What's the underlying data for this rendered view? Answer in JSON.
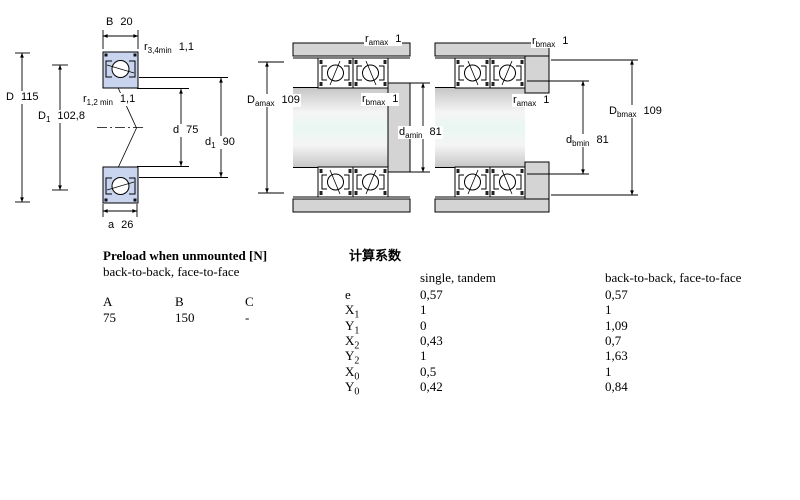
{
  "figure": {
    "left": {
      "B": {
        "base": "B",
        "sub": "",
        "value": "20"
      },
      "r34": {
        "base": "r",
        "sub": "3,4min",
        "value": "1,1"
      },
      "D": {
        "base": "D",
        "sub": "",
        "value": "115"
      },
      "D1": {
        "base": "D",
        "sub": "1",
        "value": "102,8"
      },
      "r12": {
        "base": "r",
        "sub": "1,2 min",
        "value": "1,1"
      },
      "d": {
        "base": "d",
        "sub": "",
        "value": "75"
      },
      "d1": {
        "base": "d",
        "sub": "1",
        "value": "90"
      },
      "a": {
        "base": "a",
        "sub": "",
        "value": "26"
      }
    },
    "middle": {
      "ramax": {
        "base": "r",
        "sub": "amax",
        "value": "1"
      },
      "Damax": {
        "base": "D",
        "sub": "amax",
        "value": "109"
      },
      "rbmax": {
        "base": "r",
        "sub": "bmax",
        "value": "1"
      },
      "damin": {
        "base": "d",
        "sub": "amin",
        "value": "81"
      }
    },
    "right": {
      "rbmax": {
        "base": "r",
        "sub": "bmax",
        "value": "1"
      },
      "ramax": {
        "base": "r",
        "sub": "amax",
        "value": "1"
      },
      "Dbmax": {
        "base": "D",
        "sub": "bmax",
        "value": "109"
      },
      "dbmin": {
        "base": "d",
        "sub": "bmin",
        "value": "81"
      }
    }
  },
  "preload": {
    "title": "Preload when unmounted [N]",
    "subtitle": "back-to-back, face-to-face",
    "columns": [
      "A",
      "B",
      "C"
    ],
    "values": [
      "75",
      "150",
      "-"
    ]
  },
  "factors": {
    "title": "计算系数",
    "col_single": "single, tandem",
    "col_btb": "back-to-back, face-to-face",
    "rows": [
      {
        "base": "e",
        "sub": "",
        "single": "0,57",
        "btb": "0,57"
      },
      {
        "base": "X",
        "sub": "1",
        "single": "1",
        "btb": "1"
      },
      {
        "base": "Y",
        "sub": "1",
        "single": "0",
        "btb": "1,09"
      },
      {
        "base": "X",
        "sub": "2",
        "single": "0,43",
        "btb": "0,7"
      },
      {
        "base": "Y",
        "sub": "2",
        "single": "1",
        "btb": "1,63"
      },
      {
        "base": "X",
        "sub": "0",
        "single": "0,5",
        "btb": "1"
      },
      {
        "base": "Y",
        "sub": "0",
        "single": "0,42",
        "btb": "0,84"
      }
    ]
  }
}
